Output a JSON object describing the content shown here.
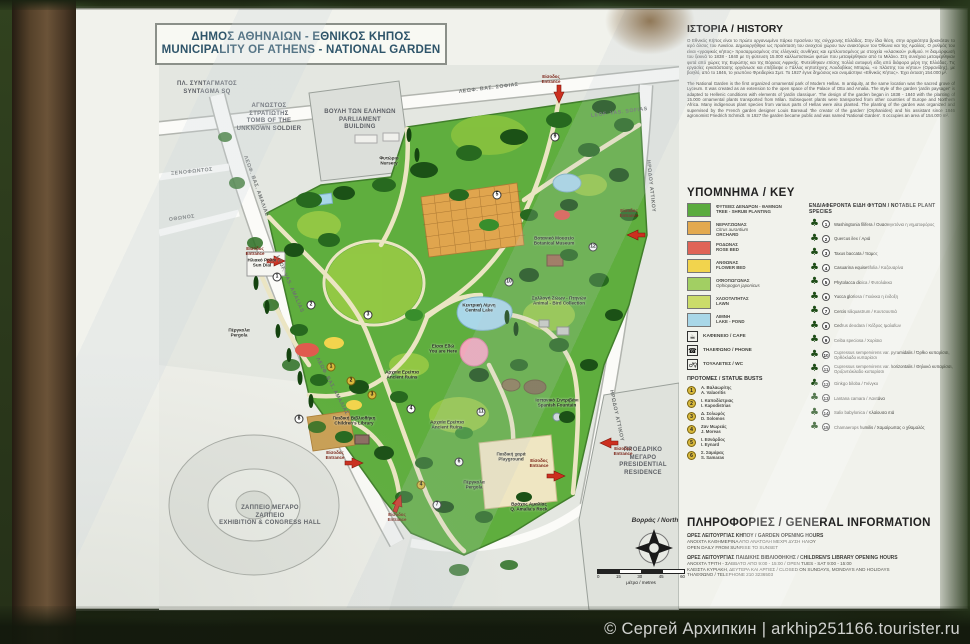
{
  "photo": {
    "watermark": "© Сергей Архипкин | arkhip251166.tourister.ru"
  },
  "sign": {
    "title": {
      "el": "ΔΗΜΟΣ ΑΘΗΝΑΙΩΝ  -  ΕΘΝΙΚΟΣ ΚΗΠΟΣ",
      "en": "MUNICIPALITY OF ATHENS - NATIONAL GARDEN"
    },
    "map": {
      "surroundings": [
        {
          "l1": "ΠΛ. ΣΥΝΤΑΓΜΑΤΟΣ",
          "l2": "SYNTAGMA SQ",
          "l3": "",
          "l4": "",
          "x": 2,
          "y": 16,
          "w": 92
        },
        {
          "l1": "ΑΓΝΩΣΤΟΣ",
          "l2": "ΣΤΡΑΤΙΩΤΗΣ",
          "l3": "TOMB OF THE",
          "l4": "UNKNOWN SOLDIER",
          "x": 64,
          "y": 38,
          "w": 92
        },
        {
          "l1": "ΒΟΥΛΗ ΤΩΝ ΕΛΛΗΝΩΝ",
          "l2": "PARLIAMENT",
          "l3": "BUILDING",
          "l4": "",
          "x": 148,
          "y": 44,
          "w": 106
        },
        {
          "l1": "ΖΑΠΠΕΙΟ ΜΕΓΑΡΟ",
          "l2": "ΖΑΠΠΕΙΟ",
          "l3": "EXHIBITION & CONGRESS HALL",
          "l4": "",
          "x": 32,
          "y": 440,
          "w": 158
        },
        {
          "l1": "ΠΡΟΕΔΡΙΚΟ",
          "l2": "ΜΕΓΑΡΟ",
          "l3": "PRESIDENTIAL",
          "l4": "RESIDENCE",
          "x": 446,
          "y": 382,
          "w": 76
        }
      ],
      "street_labels": [
        {
          "name": "ΛΕΩΦ. ΒΑΣ. ΣΟΦΙΑΣ",
          "x": 300,
          "y": 24,
          "rot": -7
        },
        {
          "name": "LEOF. VAS. SOFIAS",
          "x": 432,
          "y": 48,
          "rot": -7
        },
        {
          "name": "ΛΕΩΦ. ΒΑΣ. ΑΜΑΛΙΑΣ",
          "x": 86,
          "y": 88,
          "rot": 70
        },
        {
          "name": "LEOF. VAS. AMALIAS",
          "x": 118,
          "y": 188,
          "rot": 66
        },
        {
          "name": "ΛΕΩΦ. ΒΑΣ. ΑΜΑΛΙΑΣ",
          "x": 158,
          "y": 290,
          "rot": 62
        },
        {
          "name": "ΞΕΝΟΦΩΝΤΟΣ",
          "x": 12,
          "y": 106,
          "rot": -6
        },
        {
          "name": "ΟΘΩΝΟΣ",
          "x": 10,
          "y": 152,
          "rot": -8
        },
        {
          "name": "ΗΡΩΔΟΥ ΑΤΤΙΚΟΥ",
          "x": 489,
          "y": 92,
          "rot": 84
        },
        {
          "name": "ΗΡΩΔΟΥ ΑΤΤΙΚΟΥ",
          "x": 452,
          "y": 322,
          "rot": 78
        }
      ],
      "features": [
        {
          "el": "Φυτώριο",
          "en": "Nursery",
          "x": 230,
          "y": 96
        },
        {
          "el": "Ηλιακό Ρολόι",
          "en": "Sun Dial",
          "x": 103,
          "y": 198
        },
        {
          "el": "Βοτανικό Μουσείο",
          "en": "Botanical Museum",
          "x": 395,
          "y": 176
        },
        {
          "el": "Κεντρική Λίμνη",
          "en": "Central Lake",
          "x": 320,
          "y": 243
        },
        {
          "el": "Συλλογή Ζώων - Πτηνών",
          "en": "Animal - Bird Collection",
          "x": 400,
          "y": 236
        },
        {
          "el": "Είσαι Εδώ",
          "en": "You are Here",
          "x": 284,
          "y": 284
        },
        {
          "el": "Αρχαία Ερείπια",
          "en": "Ancient Ruins",
          "x": 243,
          "y": 310
        },
        {
          "el": "Αρχαία Ερείπια",
          "en": "Ancient Ruins",
          "x": 288,
          "y": 360
        },
        {
          "el": "Ισπανικό Σιντριβάνι",
          "en": "Spanish Fountain",
          "x": 398,
          "y": 338
        },
        {
          "el": "Παιδική χαρά",
          "en": "Playground",
          "x": 352,
          "y": 392
        },
        {
          "el": "Παιδική Βιβλιοθήκη",
          "en": "Children's Library",
          "x": 195,
          "y": 356
        },
        {
          "el": "Βράχος Αμαλίας",
          "en": "Q. Amalia's Rock",
          "x": 370,
          "y": 442
        },
        {
          "el": "Πέργκολα",
          "en": "Pergola",
          "x": 80,
          "y": 268
        },
        {
          "el": "Πέργκολα",
          "en": "Pergola",
          "x": 315,
          "y": 420
        }
      ],
      "entrances": [
        {
          "el": "Είσοδος",
          "en": "Entrance",
          "x": 392,
          "y": 14
        },
        {
          "el": "Είσοδος",
          "en": "Entrance",
          "x": 96,
          "y": 186
        },
        {
          "el": "Είσοδος",
          "en": "Entrance",
          "x": 176,
          "y": 390
        },
        {
          "el": "Είσοδος",
          "en": "Entrance",
          "x": 238,
          "y": 452
        },
        {
          "el": "Είσοδος",
          "en": "Entrance",
          "x": 380,
          "y": 398
        },
        {
          "el": "Είσοδος",
          "en": "Entrance",
          "x": 470,
          "y": 148
        },
        {
          "el": "Είσοδος",
          "en": "Entrance",
          "x": 464,
          "y": 386
        }
      ],
      "markers": [
        {
          "n": "1",
          "x": 118,
          "y": 212
        },
        {
          "n": "2",
          "x": 152,
          "y": 240
        },
        {
          "n": "3",
          "x": 209,
          "y": 250
        },
        {
          "n": "4",
          "x": 252,
          "y": 344
        },
        {
          "n": "5",
          "x": 338,
          "y": 130
        },
        {
          "n": "6",
          "x": 300,
          "y": 397
        },
        {
          "n": "7",
          "x": 278,
          "y": 440
        },
        {
          "n": "8",
          "x": 140,
          "y": 354
        },
        {
          "n": "9",
          "x": 396,
          "y": 72
        },
        {
          "n": "10",
          "x": 350,
          "y": 217
        },
        {
          "n": "11",
          "x": 322,
          "y": 347
        },
        {
          "n": "12",
          "x": 434,
          "y": 182
        },
        {
          "n": "1",
          "x": 172,
          "y": 302,
          "g": 1
        },
        {
          "n": "2",
          "x": 192,
          "y": 316,
          "g": 1
        },
        {
          "n": "3",
          "x": 213,
          "y": 330,
          "g": 1
        },
        {
          "n": "4",
          "x": 262,
          "y": 420,
          "g": 1
        }
      ],
      "north": "Βορράς / North",
      "scale": {
        "ticks": [
          {
            "t": "0"
          },
          {
            "t": "15"
          },
          {
            "t": "30"
          },
          {
            "t": "45"
          },
          {
            "t": "60"
          }
        ],
        "unit": "μέτρα / metres"
      }
    },
    "history": {
      "heading": "ΙΣΤΟΡΙΑ / HISTORY",
      "paragraph_el": "Ο Εθνικός Κήπος είναι το πρώτο οργανωμένο πάρκο πρασίνου της σύγχρονης Ελλάδας. Στην ίδια θέση, στην αρχαιότητα βρισκόταν το ιερό άλσος του Λυκείου. Δημιουργήθηκε ως προέκταση του ανοιχτού χώρου των ανακτόρων του Όθωνα και της Αμαλίας. Ο ρυθμός του είναι «γραφικός κήπος» προσαρμοσμένος στις ελληνικές συνθήκες και εμπλουτισμένος με στοιχεία «κλασικού» ρυθμού. Η διαμόρφωσή του ξεκινά το 1838 - 1840 με τη φύτευση 15.000 καλλωπιστικών φυτών που μεταφέρθηκαν από το Μιλάνο. Στη συνέχεια μεταφέρθηκαν φυτά από χώρες της Ευρώπης και της Βόρειας Αφρικής. Φυτεύθηκαν επίσης πολλά αυτοφυή είδη από διάφορα μέρη της Ελλάδας. Τις εργασίες εγκατάστασης οργάνωσε και επέβλεψε ο Γάλλος κηποτέχνης Λουδοβίκος Μπαρώ, «ο πλάστης του κήπου» (Ορφανίδης), με βοηθό, από το 1846, το γεωπόνο Φρειδερίκο Σμιτ. Το 1927 έγινε δημόσιος και ονομάστηκε «Εθνικός Κήπος». Έχει έκταση 154.000 μ².",
      "paragraph_en": "The National Garden is the first organized ornamental park of Modern Hellas. In antiquity, at the same location was the sacred grove of Lyceum. It was created as an extension to the open space of the Palace of Otto and Amalia. The style of the garden 'jardin paysager' is adapted to Hellenic conditions with elements of 'jardin classique'. The design of the garden began in 1838 - 1840 with the planting of 15.000 ornamental plants transported from Milan. Subsequent plants were transported from other countries of Europe and Northern Africa. Many indigenous plant species from various parts of Hellas were also planted. The planting of the garden was organized and supervised by the French garden designer Louis Bareaud 'the creator of the garden' (Orphanides) and his assistant since 1846 agronomist Friedrich Schmidt. In 1927 the garden became public and was named 'National Garden'. It occupies an area of 154.000 m²."
    },
    "key": {
      "heading": "ΥΠΟΜΝΗΜΑ / KEY",
      "areas": [
        {
          "el": "ΦΥΤΕΙΕΣ ΔΕΝΔΡΩΝ - ΘΑΜΝΩΝ",
          "latin": "",
          "en": "TREE - SHRUB PLANTING",
          "color": "#5aab3e"
        },
        {
          "el": "ΝΕΡΑΤΖΙΩΝΑΣ",
          "latin": "Citrus aurantium",
          "en": "ORCHARD",
          "color": "#e3a94f",
          "pattern": "grid"
        },
        {
          "el": "ΡΟΔΩΝΑΣ",
          "latin": "",
          "en": "ROSE BED",
          "color": "#e06457"
        },
        {
          "el": "ΑΝΘΩΝΑΣ",
          "latin": "",
          "en": "FLOWER BED",
          "color": "#f2d44d"
        },
        {
          "el": "ΟΦΙΟΠΩΓΩΝΑΣ",
          "latin": "Ophiopogon japonicus",
          "en": "",
          "color": "#a2cf63"
        },
        {
          "el": "ΧΛΟΟΤΑΠΗΤΑΣ",
          "latin": "",
          "en": "LAWN",
          "color": "#cbdc6a"
        },
        {
          "el": "ΛΙΜΝΗ",
          "latin": "",
          "en": "LAKE - POND",
          "color": "#a9d7e8"
        }
      ],
      "amenities": [
        {
          "icon": "cafe",
          "label": "ΚΑΦΕΝΕΙΟ / CAFE"
        },
        {
          "icon": "phone",
          "label": "ΤΗΛΕΦΩΝΟ / PHONE"
        },
        {
          "icon": "wc",
          "label": "ΤΟΥΑΛΕΤΕΣ / WC"
        }
      ],
      "busts_heading": "ΠΡΟΤΟΜΕΣ / STATUE BUSTS",
      "busts": [
        {
          "n": "1",
          "el": "Α. Βαλαωρίτης",
          "en": "A. Valaoritis"
        },
        {
          "n": "2",
          "el": "Ι. Καποδίστριας",
          "en": "I. Kapodistrias"
        },
        {
          "n": "3",
          "el": "Δ. Σολωμός",
          "en": "D. Solomos"
        },
        {
          "n": "4",
          "el": "Ζαν Μωρεάς",
          "en": "J. Moreas"
        },
        {
          "n": "5",
          "el": "Ι. Εϋνάρδος",
          "en": "I. Eynard"
        },
        {
          "n": "6",
          "el": "Σ. Σαμάρας",
          "en": "S. Samaras"
        }
      ],
      "species_heading": "ΕΝΔΙΑΦΕΡΟΝΤΑ ΕΙΔΗ ΦΥΤΩΝ / NOTABLE PLANT SPECIES",
      "species": [
        {
          "n": "1",
          "name": "Washingtonia filifera / Ουασινγκτόνια η νηματοφόρος"
        },
        {
          "n": "2",
          "name": "Quercus ilex / Αριά"
        },
        {
          "n": "3",
          "name": "Taxus baccata / Ίταμος"
        },
        {
          "n": "4",
          "name": "Casuarina equisetifolia / Καζουαρίνα"
        },
        {
          "n": "5",
          "name": "Phytolacca dioica / Φυτολάκκα"
        },
        {
          "n": "6",
          "name": "Yucca gloriosa / Γιούκκα η ένδοξη"
        },
        {
          "n": "7",
          "name": "Cercis siliquastrum / Κουτσουπιά"
        },
        {
          "n": "8",
          "name": "Cedrus deodara / Κέδρος Ιμαλαΐων"
        },
        {
          "n": "9",
          "name": "Ceiba speciosa / Χορίσια"
        },
        {
          "n": "10",
          "name": "Cupressus sempervirens var. pyramidalis / Όρθιο κυπαρίσσι, Ορθόκλαδο κυπαρίσσι"
        },
        {
          "n": "11",
          "name": "Cupressus sempervirens var. horizontalis / Θηλυκό κυπαρίσσι, Οριζοντιόκλαδο κυπαρίσσι"
        },
        {
          "n": "12",
          "name": "Ginkgo biloba / Γκίνγκο"
        },
        {
          "n": "13",
          "name": "Lantana camara / Λαντάνα"
        },
        {
          "n": "14",
          "name": "Salix babylonica / Κλαίουσα ιτιά"
        },
        {
          "n": "15",
          "name": "Chamaerops humilis / Χαμαίρωπας ο χθαμαλός"
        }
      ]
    },
    "info": {
      "heading": "ΠΛΗΡΟΦΟΡΙΕΣ / GENERAL INFORMATION",
      "garden_hours_title": "ΩΡΕΣ ΛΕΙΤΟΥΡΓΙΑΣ ΚΗΠΟΥ / GARDEN OPENING HOURS",
      "garden_hours_el": "ΑΝΟΙΧΤΑ ΚΑΘΗΜΕΡΙΝΑ ΑΠΟ ΑΝΑΤΟΛΗ ΜΕΧΡΙ ΔΥΣΗ ΗΛΙΟΥ",
      "garden_hours_en": "OPEN DAILY FROM SUNRISE TO SUNSET",
      "library_hours_title": "ΩΡΕΣ ΛΕΙΤΟΥΡΓΙΑΣ ΠΑΙΔΙΚΗΣ ΒΙΒΛΙΟΘΗΚΗΣ / CHILDREN'S LIBRARY OPENING HOURS",
      "library_hours_1": "ΑΝΟΙΧΤΑ ΤΡΙΤΗ - ΣΑΒΒΑΤΟ ΑΠΟ 9:00 - 15:00 / OPEN TUES - SAT 9:00 - 15:00",
      "library_hours_2": "ΚΛΕΙΣΤΑ ΚΥΡΙΑΚΗ, ΔΕΥΤΕΡΑ ΚΑΙ ΑΡΓΙΕΣ / CLOSED ON SUNDAYS, MONDAYS AND HOLIDAYS",
      "phone": "ΤΗΛΕΦΩΝΟ / TELEPHONE 210 3236503"
    }
  }
}
